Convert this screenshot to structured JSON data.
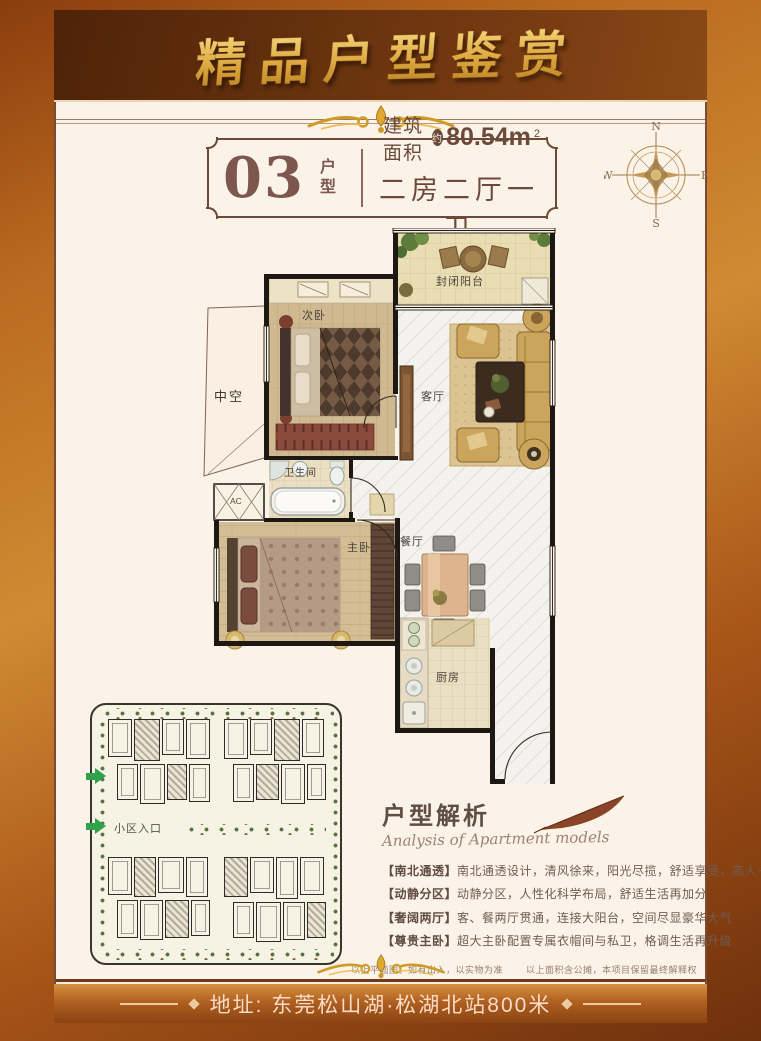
{
  "banner": {
    "title": "精品户型鉴赏"
  },
  "header": {
    "unit_number": "03",
    "unit_label": "户型",
    "area_prefix": "建筑面积",
    "area_badge": "约",
    "area_value": "80.54m",
    "area_sup": "2",
    "layout": "二房二厅一卫"
  },
  "compass": {
    "n": "N",
    "e": "E",
    "s": "S",
    "w": "W"
  },
  "floorplan": {
    "rooms": {
      "balcony": "封闭阳台",
      "second_bedroom": "次卧",
      "void": "中空",
      "living": "客厅",
      "bathroom": "卫生间",
      "ac": "AC",
      "master_bedroom": "主卧",
      "dining": "餐厅",
      "kitchen": "厨房"
    }
  },
  "siteplan": {
    "entrance_label": "小区入口"
  },
  "analysis": {
    "title": "户型解析",
    "subtitle": "Analysis of Apartment models",
    "points": [
      {
        "tag": "【南北通透】",
        "text": "南北通透设计，清风徐来，阳光尽揽，舒适享受，高人一等"
      },
      {
        "tag": "【动静分区】",
        "text": "动静分区，人性化科学布局，舒适生活再加分"
      },
      {
        "tag": "【奢阔两厅】",
        "text": "客、餐两厅贯通，连接大阳台，空间尽显豪华大气"
      },
      {
        "tag": "【尊贵主卧】",
        "text": "超大主卧配置专属衣帽间与私卫，格调生活再升级"
      }
    ]
  },
  "disclaimer": {
    "part1": "以上平面图，如有出入，以实物为准",
    "part2": "以上面积含公摊，本项目保留最终解释权"
  },
  "address": {
    "text": "地址: 东莞松山湖·松湖北站800米"
  }
}
